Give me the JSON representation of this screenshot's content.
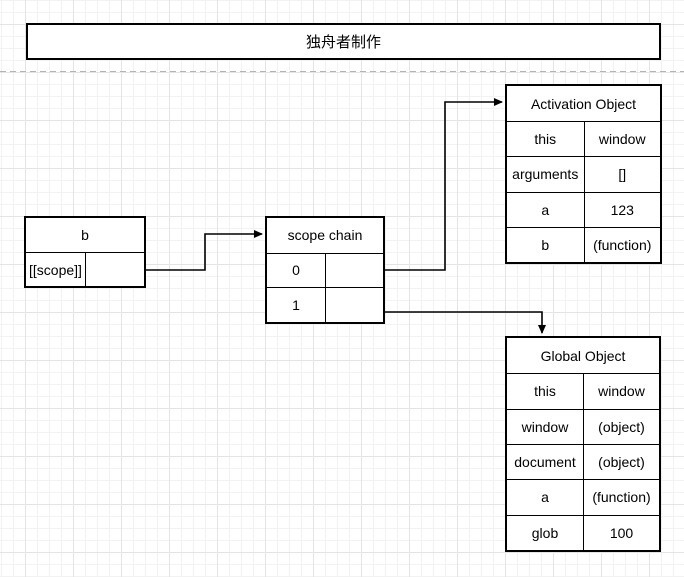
{
  "banner": {
    "title": "独舟者制作"
  },
  "boxes": {
    "b": {
      "title": "b",
      "rows": [
        {
          "key": "[[scope]]",
          "value": ""
        }
      ]
    },
    "scope_chain": {
      "title": "scope chain",
      "rows": [
        {
          "key": "0",
          "value": ""
        },
        {
          "key": "1",
          "value": ""
        }
      ]
    },
    "activation_object": {
      "title": "Activation Object",
      "rows": [
        {
          "key": "this",
          "value": "window"
        },
        {
          "key": "arguments",
          "value": "[]"
        },
        {
          "key": "a",
          "value": "123"
        },
        {
          "key": "b",
          "value": "(function)"
        }
      ]
    },
    "global_object": {
      "title": "Global Object",
      "rows": [
        {
          "key": "this",
          "value": "window"
        },
        {
          "key": "window",
          "value": "(object)"
        },
        {
          "key": "document",
          "value": "(object)"
        },
        {
          "key": "a",
          "value": "(function)"
        },
        {
          "key": "glob",
          "value": "100"
        }
      ]
    }
  },
  "colors": {
    "stroke": "#000000",
    "text": "#000000",
    "background": "#ffffff",
    "grid_minor": "#f2f2f2",
    "grid_major": "#e4e4e4",
    "page_divider": "#b3b3b3"
  }
}
